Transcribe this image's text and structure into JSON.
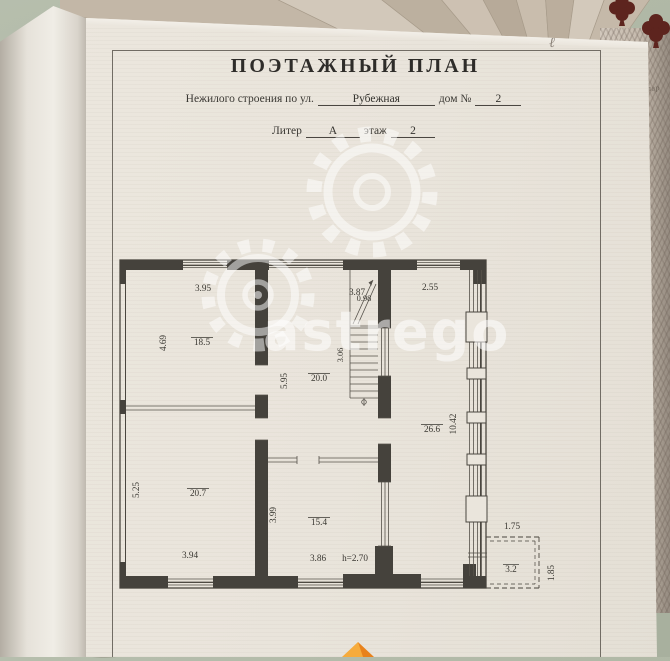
{
  "page": {
    "title": "ПОЭТАЖНЫЙ ПЛАН",
    "address_line": {
      "prefix": "Нежилого строения по ул.",
      "street": "Рубежная",
      "house_label": "дом №",
      "house_number": "2"
    },
    "liter_line": {
      "liter_label": "Литер",
      "liter_value": "А",
      "floor_label": "этаж",
      "floor_value": "2"
    },
    "handwritten_mark": "ℓ"
  },
  "floor_plan": {
    "rooms": [
      {
        "name": "top-left-room",
        "area": "18.5",
        "width": "3.95",
        "height": "4.69"
      },
      {
        "name": "middle-room",
        "area": "20.0",
        "width": "3.87",
        "height": "5.95"
      },
      {
        "name": "right-room",
        "area": "26.6",
        "width": "2.55",
        "height": "10.42"
      },
      {
        "name": "bottom-left-room",
        "area": "20.7",
        "width": "3.94",
        "height": "5.25"
      },
      {
        "name": "bottom-middle-room",
        "area": "15.4",
        "width": "3.86",
        "height": "3.99",
        "ceiling_height": "h=2.70"
      },
      {
        "name": "balcony",
        "area": "3.2",
        "width": "1.75",
        "height": "1.85"
      }
    ],
    "stairs": {
      "width": "0.98",
      "run": "3.06"
    }
  },
  "watermark": {
    "text": "astrego"
  },
  "background_document": {
    "text": "зиллар"
  },
  "colors": {
    "backdrop": "#aeb6a3",
    "paper": "#eae5dc",
    "ink": "#3a3833",
    "watermark": "rgba(255,255,255,0.55)",
    "clover": "#5d241e",
    "logo_orange": "#f09a28"
  }
}
